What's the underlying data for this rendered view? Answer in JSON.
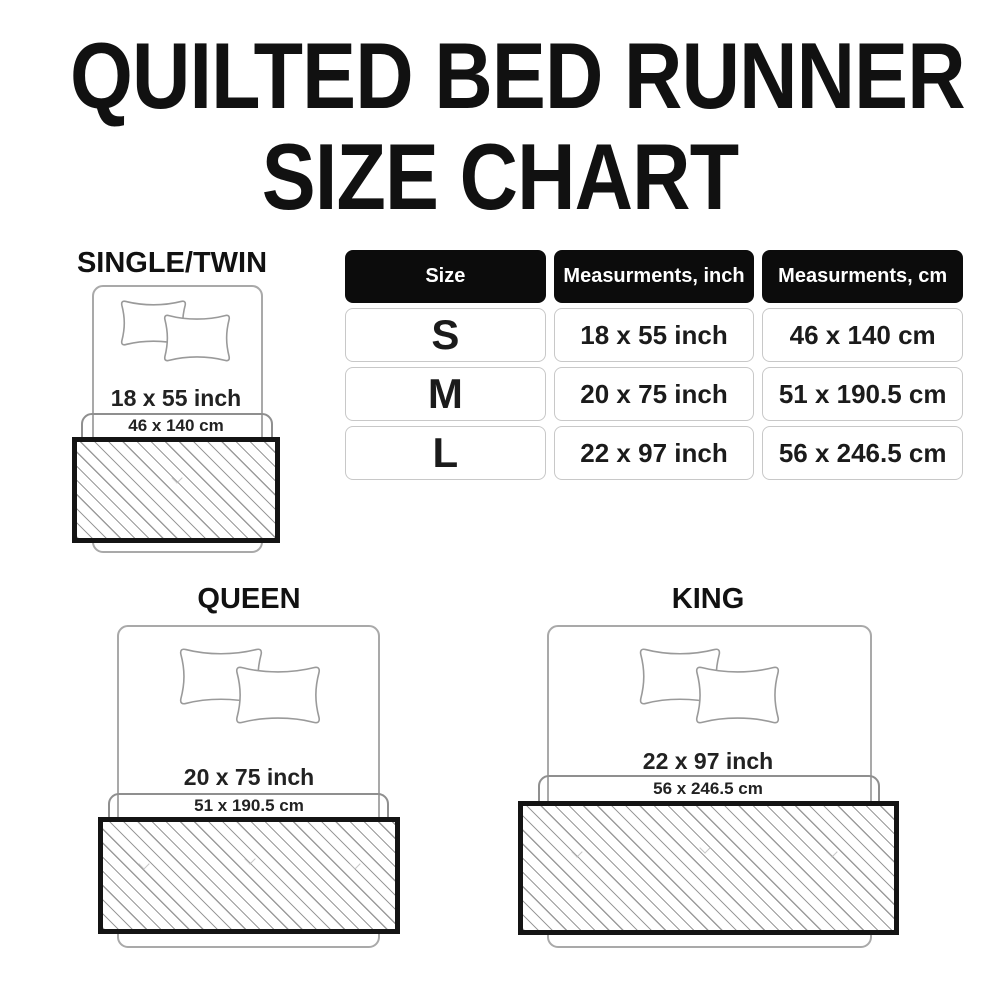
{
  "title": {
    "line1": "QUILTED BED RUNNER",
    "line2": "SIZE CHART"
  },
  "chart_data": {
    "type": "table",
    "title": "QUILTED BED RUNNER SIZE CHART",
    "columns": [
      "Size",
      "Measurments, inch",
      "Measurments, cm"
    ],
    "rows": [
      [
        "S",
        "18 x 55 inch",
        "46 x 140 cm"
      ],
      [
        "M",
        "20 x 75 inch",
        "51 x 190.5 cm"
      ],
      [
        "L",
        "22 x 97 inch",
        "56 x 246.5 cm"
      ]
    ]
  },
  "diagrams": {
    "single_twin": {
      "label": "SINGLE/TWIN",
      "inch": "18 x 55 inch",
      "cm": "46 x 140 cm"
    },
    "queen": {
      "label": "QUEEN",
      "inch": "20 x 75 inch",
      "cm": "51 x 190.5 cm"
    },
    "king": {
      "label": "KING",
      "inch": "22 x 97 inch",
      "cm": "56 x 246.5 cm"
    }
  },
  "colors": {
    "background": "#ffffff",
    "text": "#1a1a1a",
    "table_header_bg": "#0c0c0c",
    "table_header_text": "#ffffff",
    "cell_border": "#c8c8c8",
    "bed_outline": "#a9a9a9",
    "bracket_outline": "#8f8f8f",
    "runner_border": "#141414",
    "hatch_line": "#9b9b9b"
  }
}
